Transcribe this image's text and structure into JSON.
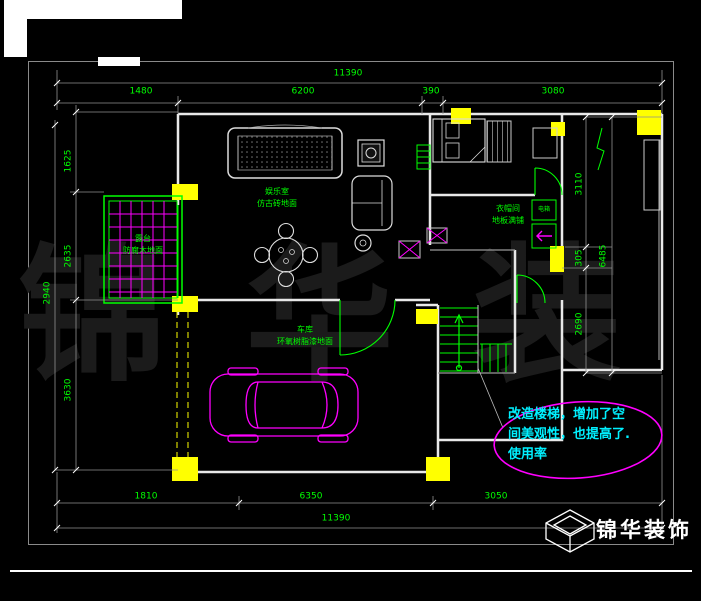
{
  "colors": {
    "background": "#000000",
    "dimension_green": "#00ff00",
    "furniture_magenta": "#ff00ff",
    "column_yellow": "#ffff00",
    "note_cyan": "#00f0ff",
    "wall_white": "#e8e8e8",
    "watermark_gray": "#1b1b1b"
  },
  "watermark": {
    "text": "锦 华 装 饰"
  },
  "logo": {
    "text": "锦华装饰",
    "icon": "cube-logo-icon"
  },
  "dimensions": {
    "top": {
      "overall": "11390",
      "segments": [
        "1480",
        "6200",
        "390",
        "3080"
      ]
    },
    "bottom": {
      "overall": "11390",
      "segments": [
        "1810",
        "6350",
        "3050"
      ]
    },
    "left": {
      "outer": "2940",
      "segments": [
        "1625",
        "2635",
        "3630"
      ]
    },
    "right": {
      "outer": "6485",
      "segments": [
        "3110",
        "305",
        "2690"
      ]
    }
  },
  "rooms": {
    "entertainment": {
      "name": "娱乐室",
      "floor": "仿古砖地面"
    },
    "terrace": {
      "name": "露台",
      "floor": "防腐木地面"
    },
    "garage": {
      "name": "车库",
      "floor": "环氧树脂漆地面"
    },
    "closet": {
      "name": "衣帽间",
      "floor": "地板满铺"
    },
    "ebox": {
      "label": "电箱"
    }
  },
  "note": {
    "lines": [
      "改造楼梯，增加了空",
      "间美观性，也提高了.",
      "使用率"
    ]
  }
}
